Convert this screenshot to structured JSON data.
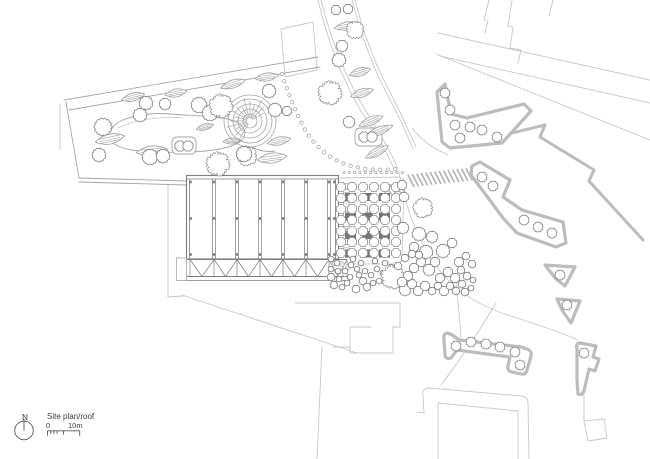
{
  "title": "Site plan/roof",
  "legend": {
    "north_label": "N",
    "scale_start": "0",
    "scale_end": "10m"
  },
  "colors": {
    "background": "#ffffff",
    "line": "#7d7d7d",
    "light": "#c8c8c8",
    "mid": "#a6a6a6",
    "strip": "#bcbcbc",
    "block": "#767676",
    "hatch": "#b2b2b2",
    "text": "#3c3c3c",
    "legend_line": "#555555"
  },
  "plan": {
    "building": {
      "x": 186.5,
      "y": 175.5,
      "w": 152,
      "h": 83.5,
      "ribs": [
        214,
        237,
        260,
        283,
        306,
        329
      ],
      "node_cols": [
        190.5,
        214,
        237,
        260,
        283,
        306,
        329,
        334.5
      ],
      "node_rows": [
        182,
        218.5,
        254.5
      ],
      "truss": {
        "top": 259.5,
        "bottom": 276.5,
        "x1": 187,
        "x2": 347,
        "verts": [
          190,
          214,
          237,
          260,
          283,
          306,
          329,
          347
        ]
      },
      "base": [
        184,
        280.5,
        350
      ],
      "planter": [
        176.5,
        258,
        10,
        22.5
      ],
      "rooflights": {
        "x": 343.5,
        "y0": 183.5,
        "w": 5.5,
        "h": 6,
        "step": 9.2,
        "count": 8
      },
      "vents": [
        [
          335,
          263
        ],
        [
          342,
          264
        ],
        [
          348,
          267
        ],
        [
          337,
          271
        ],
        [
          345,
          274
        ],
        [
          334,
          279
        ]
      ]
    },
    "courtyard": {
      "outline": "M339,178 L397,177 Q404,177 404,183 L402,257 Q402,264 395,264 L339,264",
      "block_xs": [
        345,
        362,
        379
      ],
      "block_ys": [
        193,
        212.5,
        231,
        249.5
      ],
      "block_w": 11,
      "block_h": 8,
      "tree_cols": [
        341,
        352,
        363,
        374,
        385,
        396
      ],
      "tree_rows": [
        187,
        198,
        209,
        220,
        231,
        242,
        253
      ],
      "tree_r": 5,
      "dot_row": {
        "y": 172.5,
        "x0": 344,
        "x1": 403,
        "step": 5.3,
        "r": 1.2
      }
    },
    "trees": [
      [
        103,
        127,
        9,
        0
      ],
      [
        99,
        155,
        7,
        0
      ],
      [
        140,
        115,
        7,
        0
      ],
      [
        146,
        103,
        7,
        0
      ],
      [
        165,
        104,
        6,
        0
      ],
      [
        150,
        157,
        8,
        0
      ],
      [
        163,
        156,
        7,
        0
      ],
      [
        180,
        146,
        5.5,
        0
      ],
      [
        188,
        146,
        5.5,
        0
      ],
      [
        199,
        105,
        8,
        0
      ],
      [
        210,
        113,
        8,
        0
      ],
      [
        221,
        106,
        12,
        1
      ],
      [
        218,
        164,
        12,
        1
      ],
      [
        247,
        156,
        10,
        1
      ],
      [
        244,
        154,
        8,
        0
      ],
      [
        269,
        91,
        7,
        0
      ],
      [
        275,
        110,
        7,
        0
      ],
      [
        287,
        111,
        5,
        0
      ],
      [
        336,
        10,
        5,
        0
      ],
      [
        348,
        9,
        5,
        0
      ],
      [
        355,
        30,
        9,
        1
      ],
      [
        342,
        46,
        6,
        0
      ],
      [
        339,
        60,
        7,
        0
      ],
      [
        330,
        93,
        12,
        1
      ],
      [
        349,
        122,
        6,
        0
      ],
      [
        364,
        137,
        5.5,
        0
      ],
      [
        372,
        137,
        5.5,
        0
      ],
      [
        402,
        185,
        5,
        0
      ],
      [
        404,
        197,
        5,
        0
      ],
      [
        423,
        208,
        10,
        1
      ],
      [
        403,
        228,
        6,
        0
      ],
      [
        419,
        234,
        7,
        0
      ],
      [
        432,
        237,
        6,
        0
      ],
      [
        443,
        251,
        7,
        0
      ],
      [
        452,
        243,
        5,
        0
      ],
      [
        426,
        252,
        7,
        0
      ],
      [
        414,
        247,
        5,
        0
      ],
      [
        331,
        259,
        3,
        0
      ],
      [
        337,
        263,
        3,
        0
      ],
      [
        331,
        269,
        3,
        0
      ],
      [
        338,
        271,
        3,
        0
      ],
      [
        331,
        277,
        4,
        0
      ],
      [
        339,
        279,
        3,
        0
      ],
      [
        334,
        285,
        4,
        0
      ],
      [
        342,
        287,
        3,
        0
      ],
      [
        347,
        283,
        3,
        0
      ],
      [
        350,
        277,
        3,
        0
      ],
      [
        345,
        271,
        3,
        0
      ],
      [
        351,
        265,
        3,
        0
      ],
      [
        357,
        269,
        3,
        0
      ],
      [
        353,
        259,
        3,
        0
      ],
      [
        361,
        263,
        3,
        0
      ],
      [
        359,
        275,
        3,
        0
      ],
      [
        365,
        271,
        3,
        0
      ],
      [
        363,
        281,
        4,
        0
      ],
      [
        356,
        289,
        4,
        0
      ],
      [
        367,
        287,
        4,
        0
      ],
      [
        373,
        283,
        3,
        0
      ],
      [
        371,
        275,
        3,
        0
      ],
      [
        377,
        269,
        3,
        0
      ],
      [
        383,
        273,
        3,
        0
      ],
      [
        379,
        281,
        3,
        0
      ],
      [
        387,
        279,
        3,
        0
      ],
      [
        375,
        261,
        3,
        0
      ],
      [
        385,
        263,
        3,
        0
      ],
      [
        391,
        267,
        3,
        0
      ],
      [
        393,
        277,
        12,
        1
      ],
      [
        405,
        290,
        6,
        0
      ],
      [
        412,
        284,
        5,
        0
      ],
      [
        418,
        291,
        5,
        0
      ],
      [
        425,
        286,
        5,
        0
      ],
      [
        432,
        291,
        4,
        0
      ],
      [
        438,
        286,
        4,
        0
      ],
      [
        444,
        291,
        5,
        0
      ],
      [
        450,
        286,
        4,
        0
      ],
      [
        456,
        291,
        4,
        0
      ],
      [
        440,
        278,
        5,
        0
      ],
      [
        448,
        272,
        5,
        0
      ],
      [
        455,
        278,
        5,
        0
      ],
      [
        462,
        284,
        4,
        0
      ],
      [
        465,
        292,
        4,
        0
      ],
      [
        461,
        270,
        4,
        0
      ],
      [
        467,
        276,
        4,
        0
      ],
      [
        471,
        288,
        3,
        0
      ],
      [
        473,
        280,
        3,
        0
      ],
      [
        459,
        262,
        5,
        0
      ],
      [
        466,
        256,
        4,
        0
      ],
      [
        472,
        264,
        4,
        0
      ],
      [
        429,
        270,
        6,
        0
      ],
      [
        435,
        262,
        5,
        0
      ],
      [
        421,
        262,
        5,
        0
      ],
      [
        414,
        268,
        5,
        0
      ],
      [
        408,
        276,
        5,
        0
      ],
      [
        402,
        282,
        5,
        0
      ],
      [
        398,
        266,
        4,
        0
      ],
      [
        405,
        258,
        4,
        0
      ],
      [
        412,
        254,
        4,
        0
      ],
      [
        419,
        255,
        4,
        0
      ]
    ],
    "leaves": [
      [
        133,
        97,
        12,
        4,
        -15
      ],
      [
        176,
        93,
        11,
        4,
        -10
      ],
      [
        110,
        139,
        15,
        5,
        -12
      ],
      [
        152,
        151,
        16,
        5,
        -6
      ],
      [
        205,
        127,
        9,
        3,
        -15
      ],
      [
        232,
        141,
        9,
        3,
        -5
      ],
      [
        233,
        84,
        13,
        4,
        -18
      ],
      [
        267,
        77,
        12,
        4,
        -8
      ],
      [
        279,
        141,
        12,
        4,
        -12
      ],
      [
        272,
        158,
        15,
        5,
        -8
      ],
      [
        347,
        26,
        13,
        4,
        -10
      ],
      [
        360,
        72,
        11,
        4,
        -16
      ],
      [
        362,
        93,
        12,
        4,
        -18
      ],
      [
        371,
        121,
        13,
        4,
        -22
      ],
      [
        379,
        131,
        15,
        4,
        -22
      ],
      [
        377,
        152,
        13,
        4,
        -28
      ]
    ],
    "park_loop": "M113,127 C120,117 150,112 170,114 C195,116 228,116 238,123 C246,128 247,136 241,141 C231,149 205,152 185,152 C160,153 130,152 118,146 C108,141 106,134 113,127 Z",
    "park_inner": "M118,128 C136,119 162,116 183,118",
    "planters": [
      [
        172,
        137,
        24,
        17
      ],
      [
        355,
        128,
        27,
        18
      ]
    ],
    "spiral": {
      "cx": 250,
      "cy": 121,
      "rings": [
        7,
        12,
        17,
        22,
        26
      ],
      "fan_from": 120,
      "fan_to": 330,
      "fan_step": 15,
      "tail": "M252,147 Q263,153 275,151"
    },
    "dot_arcs": [
      {
        "d": "M282,74 Q290,100 303,126 Q317,152 342,163 Q366,172 396,169",
        "spacing": 7.5,
        "r": 1.7
      }
    ],
    "hatch_bands": [
      {
        "x1": 409,
        "y1": 181,
        "x2": 488,
        "y2": 172,
        "w": 13
      },
      {
        "x1": 382,
        "y1": 191,
        "x2": 403,
        "y2": 187,
        "w": 11
      }
    ],
    "strips": [
      {
        "path": "M445,84 L437,92 L442,142 L450,148 L502,143 L531,111 L524,104 L467,118 L451,114 Z",
        "trees": [
          [
            445,
            93
          ],
          [
            450,
            110
          ],
          [
            455,
            125
          ],
          [
            470,
            127
          ],
          [
            482,
            130
          ],
          [
            497,
            137
          ],
          [
            460,
            138
          ]
        ]
      },
      {
        "path": "M472,166 L480,162 L510,180 L503,197 L522,210 L563,222 L566,243 L556,247 L517,233 L503,218 L489,199 L471,175 Z",
        "trees": [
          [
            482,
            177
          ],
          [
            493,
            186
          ],
          [
            524,
            220
          ],
          [
            538,
            227
          ],
          [
            552,
            233
          ]
        ]
      },
      {
        "path": "M545,265 L575,267 L565,286 L556,279 Z",
        "trees": [
          [
            560,
            275
          ]
        ]
      },
      {
        "path": "M557,299 L580,301 L571,323 L562,310 Z",
        "trees": [
          [
            567,
            305
          ]
        ]
      },
      {
        "path": "M447,333 Q443,334 444,340 L445,355 Q446,360 451,358 L457,350 L510,357 L508,366 Q507,371 512,372 L521,374 Q526,375 527,370 L531,356 Q532,351 527,349 L521,347 L459,340 Q452,334 447,333 Z",
        "trees": [
          [
            456,
            346
          ],
          [
            471,
            342
          ],
          [
            486,
            344
          ],
          [
            500,
            347
          ],
          [
            515,
            352
          ],
          [
            520,
            365
          ]
        ]
      },
      {
        "path": "M577,349 Q575,344 580,343 L596,346 L593,357 L599,359 L595,371 L589,369 L584,391 Q582,396 578,394 L577,380 Z",
        "trees": [
          [
            584,
            353
          ]
        ]
      }
    ],
    "walls": [
      "M458,146 L545,125 L540,137 L594,170 L589,181 L643,240"
    ],
    "boundaries": [
      "M64,100 L318,57",
      "M69,110 L320,67",
      "M66,102 L79,178",
      "M79,178 L186,181",
      "M79,182 L186,185"
    ],
    "light_lines": [
      "M489,0 L484,20 L488,21 L485,33",
      "M512,0 L508,26 L513,27 L510,48 L521,50 L518,63",
      "M553,0 L549,16",
      "M438,33 L650,80",
      "M440,56 L650,103",
      "M436,54 L650,140",
      "M281,29 L313,22 L317,70 L285,77 Z",
      "M168,184 L168,297 L183,296",
      "M182,295 L357,353",
      "M322,347 L317,459",
      "M295,303 L400,303 L400,327 L393,327 L393,353 L350,353 L350,347 L333,347",
      "M350,347 L350,327 L371,327",
      "M423,395 Q422,388 429,388 L521,396 Q528,397 528,403 L529,459",
      "M423,395 L424,413 L417,412",
      "M438,459 L438,403 L518,411 L518,459",
      "M584,395 L584,420",
      "M584,421 L604,419 L607,438 L588,441 Z",
      "M321,0 C331,40 345,76 364,108 C377,128 389,148 398,169",
      "M318,0 C328,42 342,79 361,111 C374,131 386,150 395,171",
      "M352,0 C361,35 373,68 389,98 C398,114 406,132 413,149",
      "M355,0 C364,35 376,67 392,96 C400,111 408,130 416,147",
      "M412,128 Q425,145 448,155",
      "M399,173 C407,215 423,252 445,277 C463,297 487,309 514,317 C545,327 565,334 578,340",
      "M456,283 C459,310 461,330 461,345",
      "M496,303 C480,330 460,360 441,385",
      "M60,104 L60,150"
    ],
    "north": {
      "cx": 24,
      "cy": 430.5,
      "r": 9.3,
      "needle_y1": 419,
      "needle_y2": 430.5
    },
    "scalebar": {
      "x0": 47.5,
      "x1": 79.7,
      "y": 430.8,
      "ticks": [
        [
          47.5,
          5
        ],
        [
          50.7,
          3
        ],
        [
          53.9,
          3
        ],
        [
          57.1,
          3
        ],
        [
          63.6,
          4
        ],
        [
          79.7,
          5
        ]
      ]
    }
  }
}
